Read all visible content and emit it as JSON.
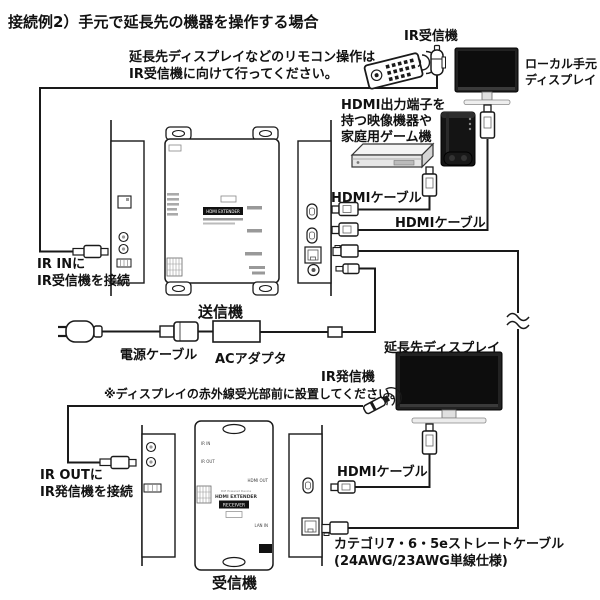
{
  "title": "接続例2）手元で延長先の機器を操作する場合",
  "note": {
    "line1": "延長先ディスプレイなどのリモコン操作は",
    "line2": "IR受信機に向けて行ってください。"
  },
  "labels": {
    "ir_receiver": "IR受信機",
    "local_display_line1": "ローカル手元",
    "local_display_line2": "ディスプレイ",
    "source_line1": "HDMI出力端子を",
    "source_line2": "持つ映像機器や",
    "source_line3": "家庭用ゲーム機",
    "hdmi_cable_1": "HDMIケーブル",
    "hdmi_cable_2": "HDMIケーブル",
    "ir_in_line1": "IR INに",
    "ir_in_line2": "IR受信機を接続",
    "transmitter": "送信機",
    "power_cable": "電源ケーブル",
    "ac_adapter": "ACアダプタ",
    "ext_display": "延長先ディスプレイ",
    "ir_emitter": "IR発信機",
    "ir_emitter_note": "※ディスプレイの赤外線受光部前に設置してください。",
    "ir_out_line1": "IR OUTに",
    "ir_out_line2": "IR発信機を接続",
    "hdmi_cable_rx": "HDMIケーブル",
    "cat_cable_line1": "カテゴリ7・6・5eストレートケーブル",
    "cat_cable_line2": "(24AWG/23AWG単線仕様)",
    "receiver": "受信機"
  },
  "device_text": {
    "tx_badge": "HDMI EXTENDER",
    "rx_poe": "PoE Powered Device",
    "rx_name": "HDMI EXTENDER",
    "rx_badge": "RECEIVER",
    "rx_ir_in": "IR IN",
    "rx_ir_out": "IR OUT",
    "rx_hdmi_out": "HDMI OUT",
    "rx_lan_in": "LAN IN"
  },
  "colors": {
    "line": "#1a1a1a",
    "device_dark": "#1c1c1c",
    "screen": "#0d0d0d",
    "background": "#ffffff"
  }
}
